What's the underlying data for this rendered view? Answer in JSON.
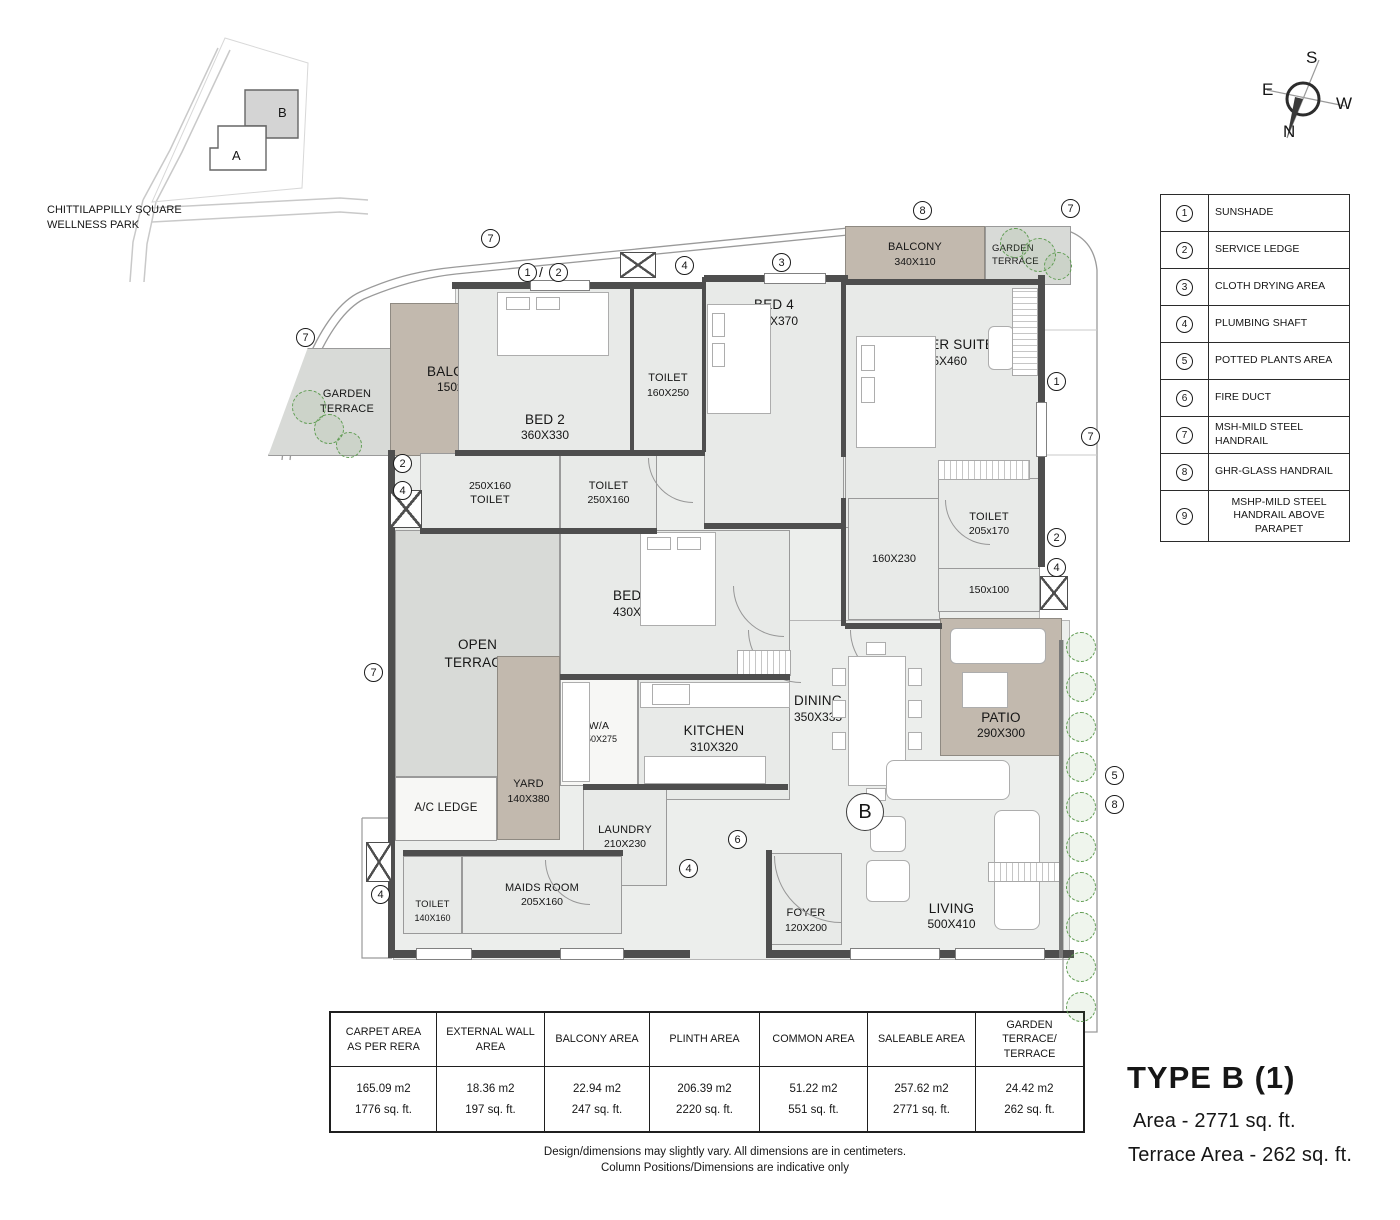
{
  "site_map": {
    "park_label_line1": "CHITTILAPPILLY SQUARE",
    "park_label_line2": "WELLNESS PARK",
    "building_a": "A",
    "building_b": "B"
  },
  "compass": {
    "top": "S",
    "left": "E",
    "right": "W",
    "bottom": "N"
  },
  "legend": {
    "items": [
      {
        "num": "1",
        "label": "SUNSHADE"
      },
      {
        "num": "2",
        "label": "SERVICE LEDGE"
      },
      {
        "num": "3",
        "label": "CLOTH DRYING AREA"
      },
      {
        "num": "4",
        "label": "PLUMBING SHAFT"
      },
      {
        "num": "5",
        "label": "POTTED PLANTS AREA"
      },
      {
        "num": "6",
        "label": "FIRE DUCT"
      },
      {
        "num": "7",
        "label": "MSH-MILD STEEL HANDRAIL"
      },
      {
        "num": "8",
        "label": "GHR-GLASS HANDRAIL"
      },
      {
        "num": "9",
        "label": "MSHP-MILD STEEL HANDRAIL ABOVE PARAPET"
      }
    ]
  },
  "rooms": {
    "garden_terrace_left": {
      "name": "GARDEN",
      "name2": "TERRACE"
    },
    "balcony_left": {
      "name": "BALCONY",
      "dims": "150x270"
    },
    "bed2": {
      "name": "BED 2",
      "dims": "360X330"
    },
    "toilet_bed2": {
      "dims": "250X160",
      "name": "TOILET"
    },
    "toilet_bed3": {
      "name": "TOILET",
      "dims": "250X160"
    },
    "toilet_top": {
      "name": "TOILET",
      "dims": "160X250"
    },
    "bed4": {
      "name": "BED 4",
      "dims": "300X370"
    },
    "master": {
      "name": "MASTER SUITE",
      "dims": "415X460"
    },
    "balcony_top": {
      "name": "BALCONY",
      "dims": "340X110"
    },
    "garden_terrace_right": {
      "name": "GARDEN",
      "name2": "TERRACE"
    },
    "walkin": {
      "dims": "160X230"
    },
    "toilet_master": {
      "name": "TOILET",
      "dims": "205x170"
    },
    "passage": {
      "dims": "150x100"
    },
    "open_terrace": {
      "name": "OPEN",
      "name2": "TERRACE"
    },
    "yard": {
      "name": "YARD",
      "dims": "140X380"
    },
    "ac_ledge": {
      "name": "A/C LEDGE"
    },
    "bed3": {
      "name": "BED 3",
      "dims": "430X320"
    },
    "wa": {
      "name": "W/A",
      "dims": "150X275"
    },
    "kitchen": {
      "name": "KITCHEN",
      "dims": "310X320"
    },
    "dining": {
      "name": "DINING",
      "dims": "350X335"
    },
    "patio": {
      "name": "PATIO",
      "dims": "290X300"
    },
    "laundry": {
      "name": "LAUNDRY",
      "dims": "210X230"
    },
    "maids": {
      "name": "MAIDS ROOM",
      "dims": "205X160"
    },
    "toilet_maids": {
      "name": "TOILET",
      "dims": "140X160"
    },
    "foyer": {
      "name": "FOYER",
      "dims": "120X200"
    },
    "living": {
      "name": "LIVING",
      "dims": "500X410"
    },
    "unit_label": "B"
  },
  "markers": [
    {
      "v": "7"
    },
    {
      "v": "1"
    },
    {
      "v": "2"
    },
    {
      "v": "4"
    },
    {
      "v": "3"
    },
    {
      "v": "8"
    },
    {
      "v": "7"
    },
    {
      "v": "7"
    },
    {
      "v": "2"
    },
    {
      "v": "4"
    },
    {
      "v": "7"
    },
    {
      "v": "4"
    },
    {
      "v": "1"
    },
    {
      "v": "7"
    },
    {
      "v": "2"
    },
    {
      "v": "4"
    },
    {
      "v": "5"
    },
    {
      "v": "8"
    },
    {
      "v": "6"
    },
    {
      "v": "4"
    }
  ],
  "marker_slash": "/",
  "area_table": {
    "columns": [
      {
        "header": "CARPET AREA AS PER RERA",
        "m2": "165.09 m2",
        "sqft": "1776 sq. ft."
      },
      {
        "header": "EXTERNAL WALL AREA",
        "m2": "18.36 m2",
        "sqft": "197 sq. ft."
      },
      {
        "header": "BALCONY AREA",
        "m2": "22.94 m2",
        "sqft": "247 sq. ft."
      },
      {
        "header": "PLINTH AREA",
        "m2": "206.39 m2",
        "sqft": "2220 sq. ft."
      },
      {
        "header": "COMMON AREA",
        "m2": "51.22 m2",
        "sqft": "551 sq. ft."
      },
      {
        "header": "SALEABLE AREA",
        "m2": "257.62 m2",
        "sqft": "2771 sq. ft."
      },
      {
        "header": "GARDEN TERRACE/ TERRACE",
        "m2": "24.42 m2",
        "sqft": "262 sq. ft."
      }
    ]
  },
  "title_block": {
    "title": "TYPE B (1)",
    "area_line": "Area - 2771 sq. ft.",
    "terrace_line": "Terrace Area - 262 sq. ft."
  },
  "disclaimer": {
    "line1": "Design/dimensions may slightly vary. All dimensions are in centimeters.",
    "line2": "Column Positions/Dimensions are indicative only"
  },
  "colors": {
    "wall": "#4e4e4e",
    "floor": "#e8eae8",
    "terrace": "#d8dad7",
    "balcony_tan": "#c2b9ae",
    "tree_green": "#5f9c52"
  }
}
